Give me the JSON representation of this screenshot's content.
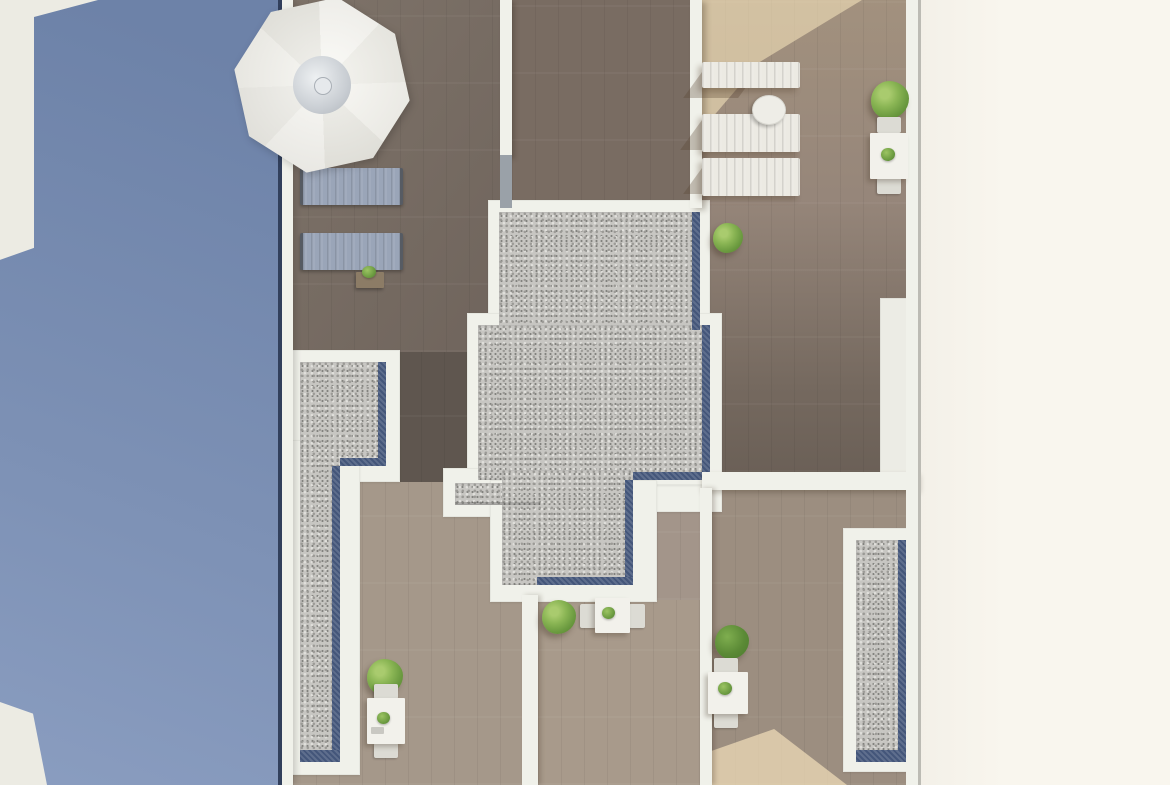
{
  "title": "Aerial 3D render of rooftop terraces",
  "visible_text": [],
  "palette": {
    "pool_blue_a": "#6d82a8",
    "pool_blue_b": "#8independent094b8",
    "pool_blue_c": "#8a9dc0",
    "pool_panel": "#ecebe3",
    "navy_edge": "#32405c",
    "wall_white": "#f0f1ea",
    "wall_grey": "#9aa1a8",
    "edge_line": "#bcbbb4",
    "deck_base": "#9f9183",
    "wood_dark": "#786d64",
    "wood_topmid": "#796c62",
    "wood_darker": "#5f564f",
    "right_top": "#a2917e",
    "right_bottom": "#6b6057",
    "wood_light": "#a5988a",
    "wood_light_b": "#9c8e80",
    "wood_arm": "#a3958a",
    "gravel_base": "#c7c6c2",
    "gravel_dark": "#9b9a96",
    "gravel_light": "#e0dfdb",
    "blue_trim": "#44567a",
    "cream_a": "#f3f0e8",
    "cream_b": "#f9f6ee",
    "lounger_blue": "#9aa5b8",
    "lounger_white": "#eceae3",
    "tree_light": "#8ab554",
    "tree_dark": "#4f7e30",
    "table_white": "#f2f1eb",
    "chair_grey": "#dcdbd4",
    "side_table_wood": "#8c7c66",
    "sun_patch": "rgba(241,222,184,0.62)",
    "shade": "rgba(85,66,48,0.30)",
    "umb_light": "#f4f3ee",
    "umb_dark": "#e5e4dd",
    "hub": "#c6cbd1"
  },
  "scene": {
    "setting": "top-down architectural rendering of apartment rooftop terraces between a blue surface (left) and a blank cream margin (right)",
    "areas": [
      {
        "name": "blue-area-left",
        "label": "blue plane with two light panels along the left edge"
      },
      {
        "name": "terrace-top-left",
        "label": "dark wood deck with white parasol, two grey-blue loungers and a small side table"
      },
      {
        "name": "terrace-top-middle",
        "label": "dark wood deck"
      },
      {
        "name": "terrace-top-right",
        "label": "wood deck with three white loungers, round side table, dining set and a tree"
      },
      {
        "name": "gravel-roof-center",
        "label": "stepped gravel roof section edged in white with dark blue drainage trim"
      },
      {
        "name": "gravel-strip-left",
        "label": "L-shaped gravel roof strip with blue trim"
      },
      {
        "name": "gravel-strip-right",
        "label": "narrow gravel roof strip with blue trim"
      },
      {
        "name": "terrace-bottom-left",
        "label": "light wood deck with tree and dining set"
      },
      {
        "name": "terrace-bottom-middle",
        "label": "light wood deck with tree and dining set"
      },
      {
        "name": "terrace-bottom-right",
        "label": "light wood deck with tree, dining set and sunlit patch"
      },
      {
        "name": "cream-margin-right",
        "label": "empty cream margin"
      }
    ],
    "furniture_counts": {
      "parasols": 1,
      "loungers_grey_blue": 2,
      "loungers_white": 3,
      "round_side_tables": 1,
      "small_side_tables": 1,
      "dining_sets": 4,
      "trees": 5,
      "table_plants": 4
    }
  }
}
